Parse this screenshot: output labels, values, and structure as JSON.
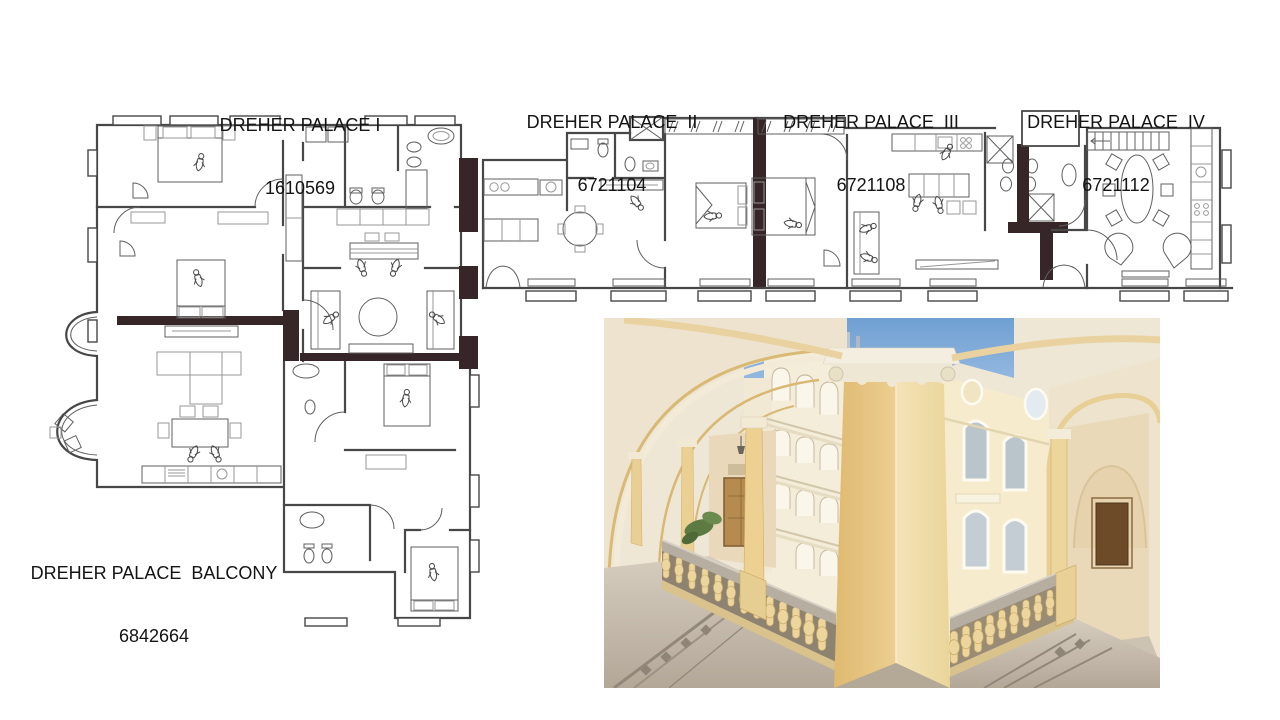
{
  "labels": {
    "palace1": {
      "title": "DREHER PALACE I",
      "code": "1610569"
    },
    "palace2": {
      "title": "DREHER PALACE  II",
      "code": "6721104"
    },
    "palace3": {
      "title": "DREHER PALACE  III",
      "code": "6721108"
    },
    "palace4": {
      "title": "DREHER PALACE  IV",
      "code": "6721112"
    },
    "balcony": {
      "title": "DREHER PALACE  BALCONY",
      "code": "6842664"
    }
  },
  "colors": {
    "plan_wall_fill": "#372628",
    "plan_line": "#474747",
    "photo_sky": "#7fa9d6",
    "photo_pillar_yellow": "#e8c97f",
    "photo_ceiling_cream": "#ece0ca",
    "photo_floor_grey": "#c9c0b2",
    "photo_facade_white": "#f4edda"
  }
}
